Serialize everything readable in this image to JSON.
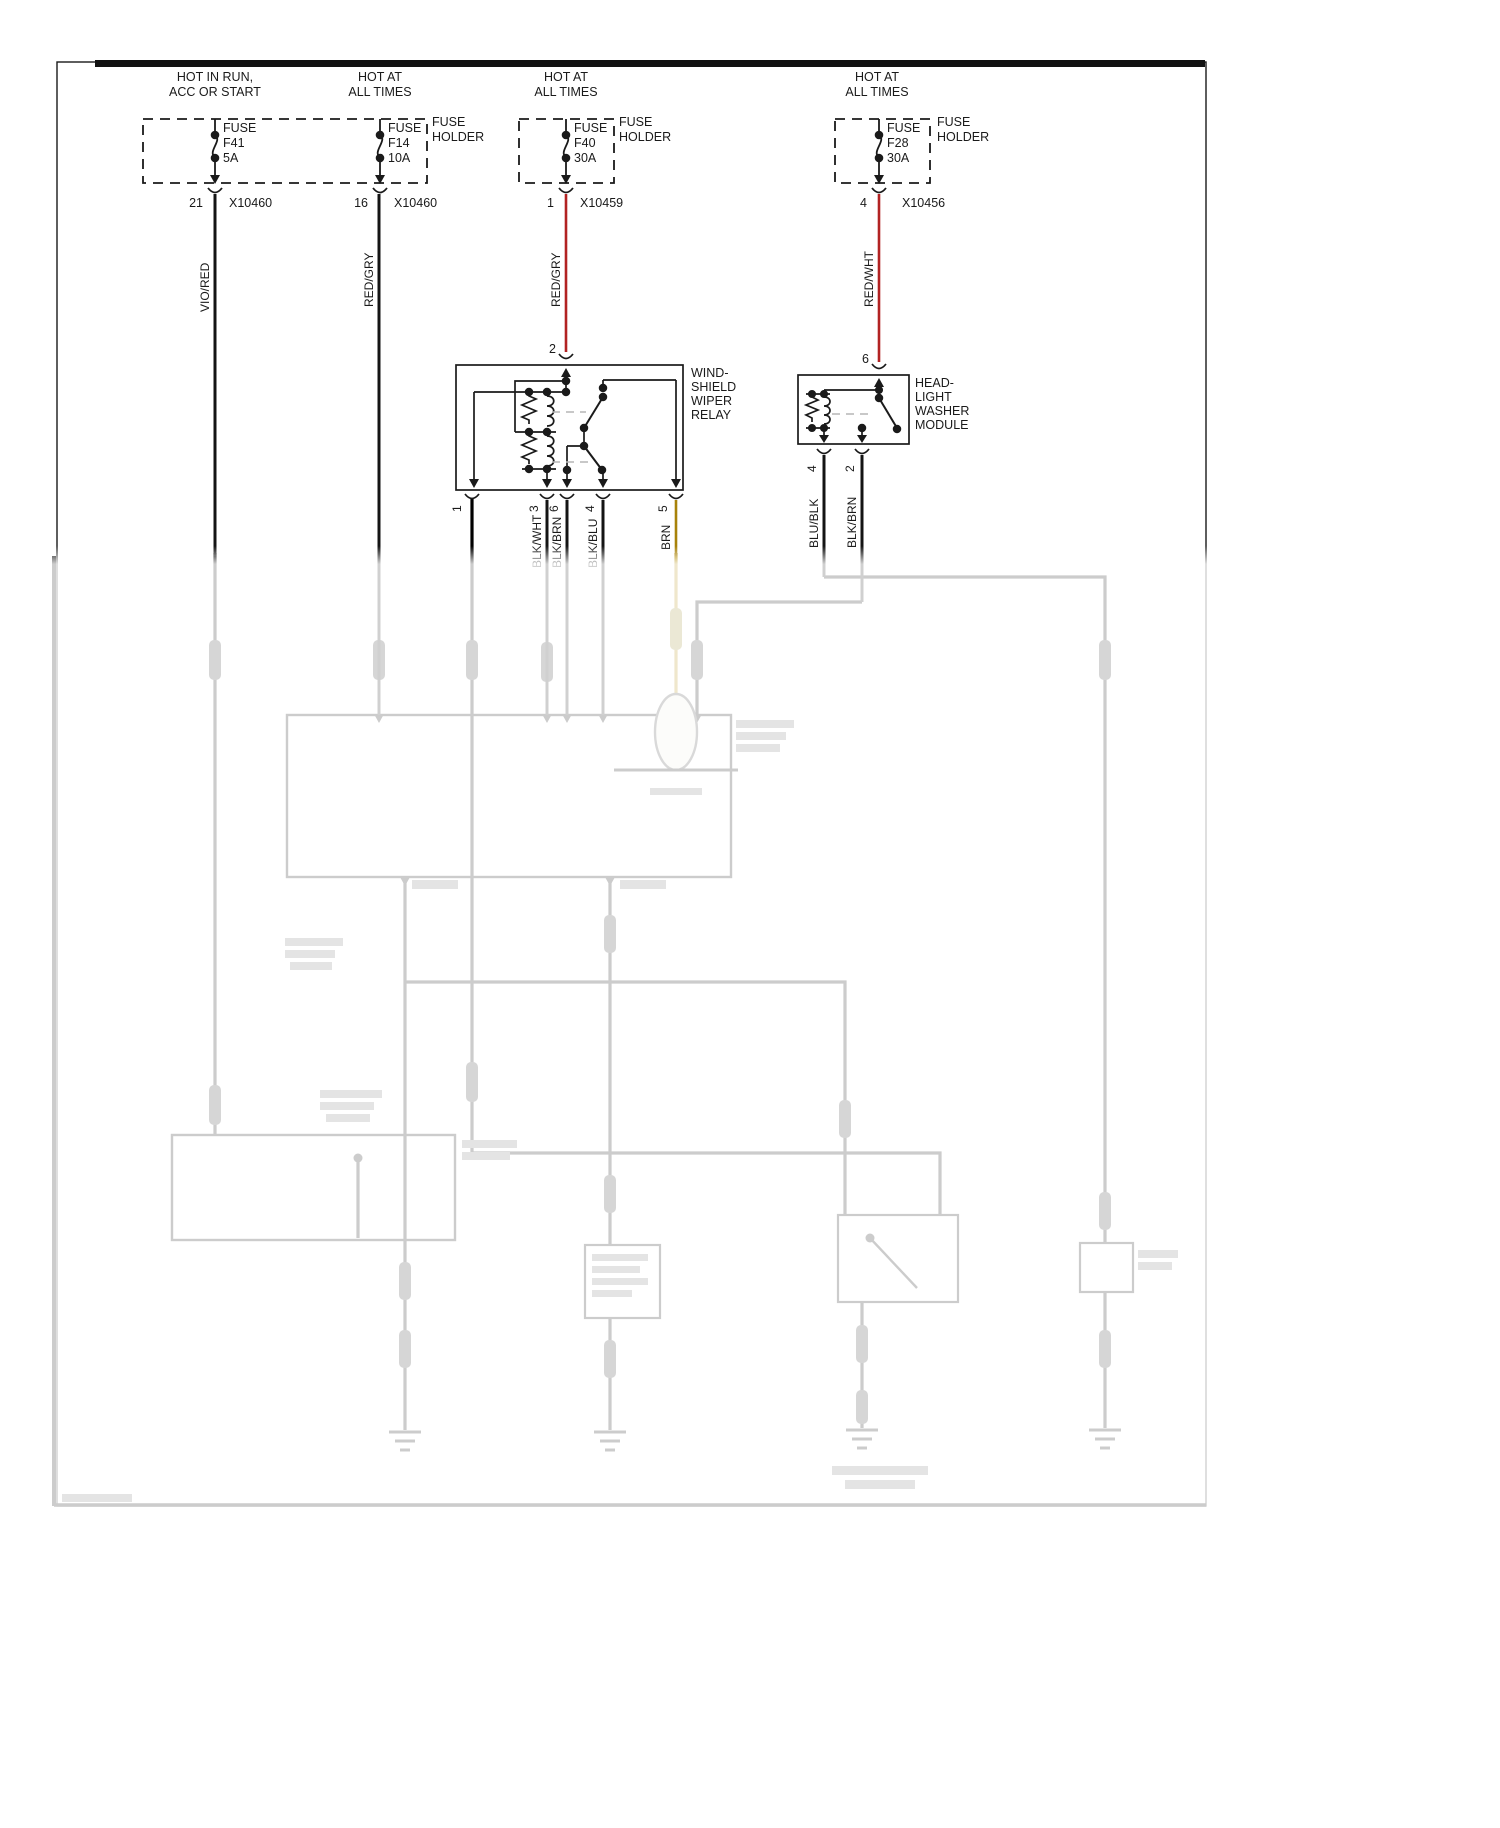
{
  "feeds": [
    {
      "header1": "HOT IN RUN,",
      "header2": "ACC OR START",
      "fuse_label": "FUSE",
      "fuse_id": "F41",
      "rating": "5A",
      "pin": "21",
      "connector": "X10460",
      "wire_label": "VIO/RED",
      "wire_color_hex": "#141414"
    },
    {
      "header1": "HOT AT",
      "header2": "ALL TIMES",
      "fuse_label": "FUSE",
      "fuse_id": "F14",
      "rating": "10A",
      "pin": "16",
      "connector": "X10460",
      "wire_label": "RED/GRY",
      "wire_color_hex": "#141414"
    },
    {
      "header1": "HOT AT",
      "header2": "ALL TIMES",
      "fuse_label": "FUSE",
      "fuse_id": "F40",
      "rating": "30A",
      "pin": "1",
      "connector": "X10459",
      "wire_label": "RED/GRY",
      "wire_color_hex": "#b22222"
    },
    {
      "header1": "HOT AT",
      "header2": "ALL TIMES",
      "fuse_label": "FUSE",
      "fuse_id": "F28",
      "rating": "30A",
      "pin": "4",
      "connector": "X10456",
      "wire_label": "RED/WHT",
      "wire_color_hex": "#b22222"
    }
  ],
  "fuse_holders": [
    {
      "line1": "FUSE",
      "line2": "HOLDER"
    },
    {
      "line1": "FUSE",
      "line2": "HOLDER"
    },
    {
      "line1": "FUSE",
      "line2": "HOLDER"
    }
  ],
  "relay": {
    "name1": "WIND-",
    "name2": "SHIELD",
    "name3": "WIPER",
    "name4": "RELAY",
    "top_pin": "2",
    "pin1": "1",
    "pin3": "3",
    "pin6": "6",
    "pin4": "4",
    "pin5": "5",
    "wire3": "BLK/WHT",
    "wire6": "BLK/BRN",
    "wire4": "BLK/BLU",
    "wire5": "BRN"
  },
  "module": {
    "name1": "HEAD-",
    "name2": "LIGHT",
    "name3": "WASHER",
    "name4": "MODULE",
    "top_pin": "6",
    "pin4": "4",
    "pin2": "2",
    "wire4": "BLU/BLK",
    "wire2": "BLK/BRN"
  },
  "colors": {
    "black_wire": "#141414",
    "red_wire": "#b22222",
    "brown_wire": "#a8820a",
    "dashed_gray": "#b5b5b5"
  }
}
